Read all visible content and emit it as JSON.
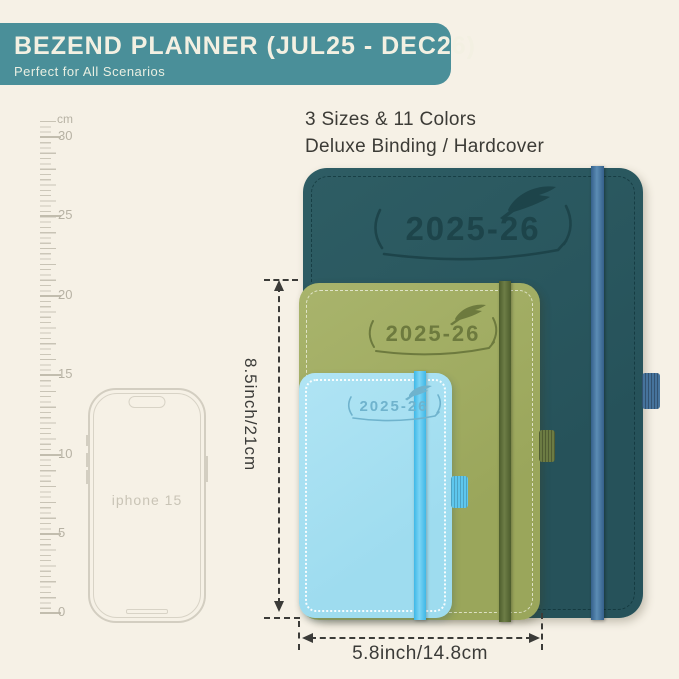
{
  "banner": {
    "title": "BEZEND PLANNER (JUL25 - DEC26)",
    "subtitle": "Perfect for All Scenarios"
  },
  "info": {
    "line1": "3 Sizes & 11 Colors",
    "line2": "Deluxe Binding / Hardcover"
  },
  "ruler": {
    "unit": "cm",
    "labels": [
      "30",
      "25",
      "20",
      "15",
      "10",
      "5",
      "0"
    ]
  },
  "phone": {
    "label": "iphone 15"
  },
  "planners": {
    "large": {
      "year": "2025-26",
      "cover_color": "#2a575d",
      "band_color": "#46739c"
    },
    "medium": {
      "year": "2025-26",
      "cover_color": "#a3ae64",
      "band_color": "#5c6b39"
    },
    "small": {
      "year": "2025-26",
      "cover_color": "#a5dff0",
      "band_color": "#57c6ee"
    }
  },
  "dimensions": {
    "height_label": "8.5inch/21cm",
    "width_label": "5.8inch/14.8cm"
  },
  "colors": {
    "background": "#f6f1e6",
    "banner": "#4a8f99",
    "annotation": "#3b3b38"
  }
}
